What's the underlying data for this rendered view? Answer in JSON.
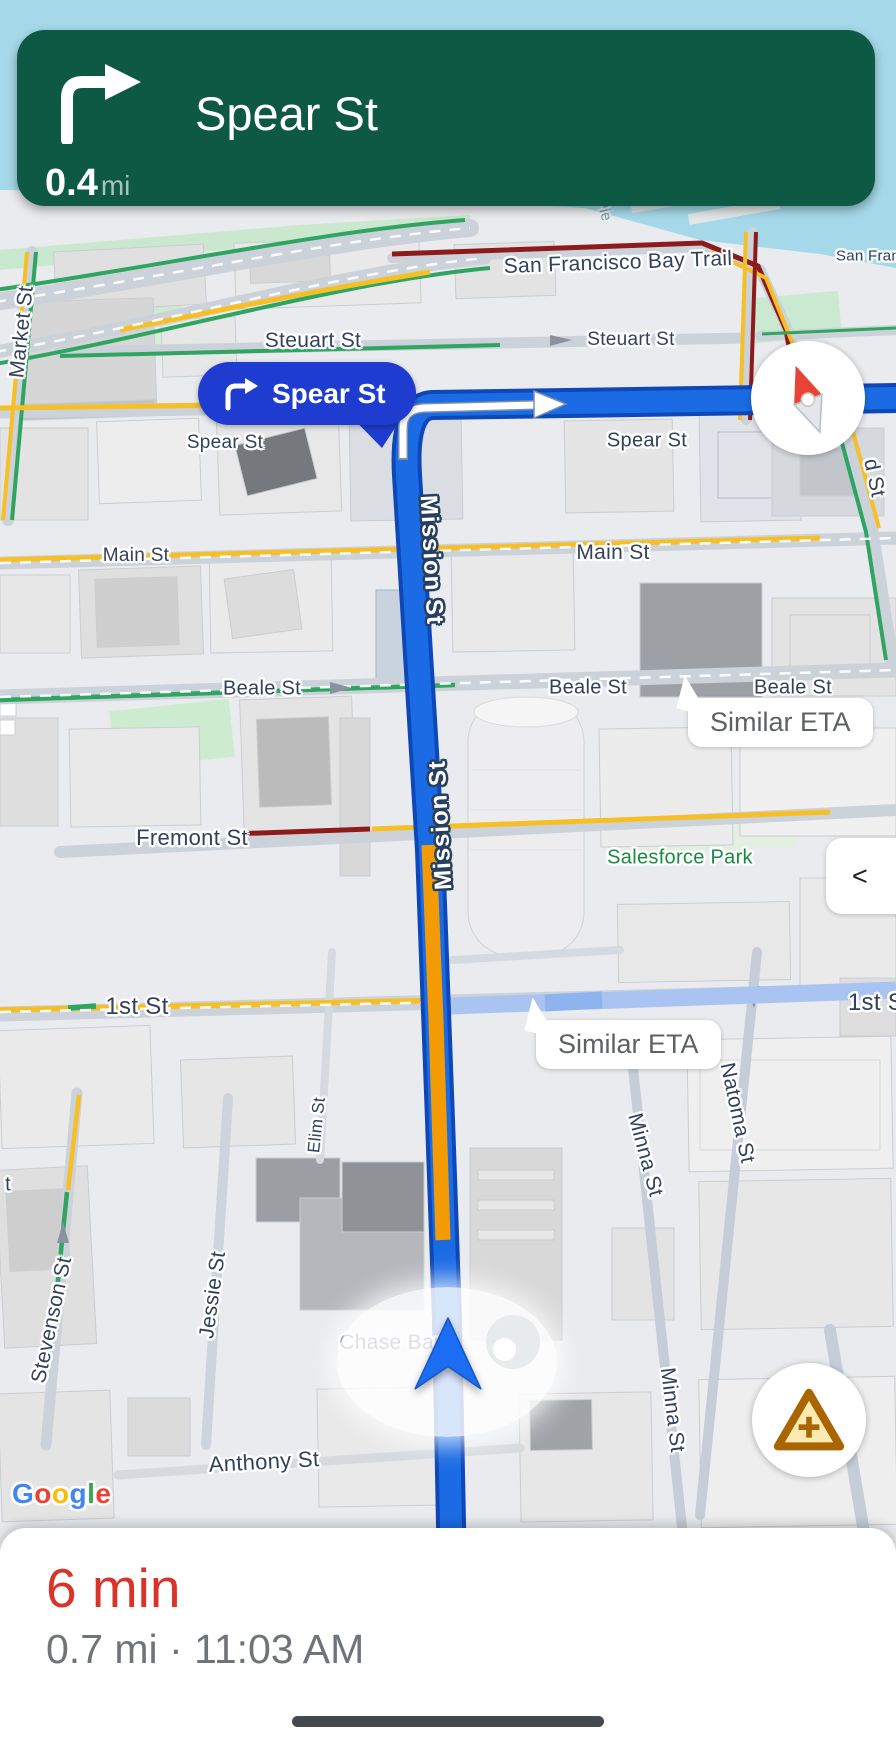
{
  "nav_banner": {
    "street": "Spear St",
    "distance": "0.4",
    "distance_unit": "mi",
    "maneuver_icon": "turn-right-icon",
    "bg_color": "#0d5943"
  },
  "turn_callout": {
    "street": "Spear St",
    "maneuver_icon": "turn-right-icon",
    "bg_color": "#1f3cd1"
  },
  "controls": {
    "compass_icon": "compass-needle-icon",
    "report_icon": "report-incident-warning-icon",
    "collapse_label": "<"
  },
  "bottom_sheet": {
    "eta": "6 min",
    "eta_color": "#da342a",
    "details": "0.7 mi · 11:03 AM"
  },
  "watermark": {
    "text": "Google",
    "letters": [
      {
        "ch": "G",
        "color": "#4285F4"
      },
      {
        "ch": "o",
        "color": "#EA4335"
      },
      {
        "ch": "o",
        "color": "#FBBC05"
      },
      {
        "ch": "g",
        "color": "#4285F4"
      },
      {
        "ch": "l",
        "color": "#34A853"
      },
      {
        "ch": "e",
        "color": "#EA4335"
      }
    ]
  },
  "map": {
    "colors": {
      "water": "#a5d9e9",
      "route": "#1b6ce4",
      "route_border": "#0d47b8",
      "traffic_moderate": "#f29b05",
      "traffic_heavy": "#8e1b1b",
      "traffic_free": "#2fa561",
      "alt_route": "#aac4f1"
    },
    "bubbles": [
      {
        "text": "Similar ETA",
        "x": 688,
        "y": 698
      },
      {
        "text": "Similar ETA",
        "x": 536,
        "y": 1020
      }
    ],
    "labels": [
      {
        "text": "Pie",
        "x": 604,
        "y": 210,
        "rot": 75,
        "kind": "pier",
        "size": 15
      },
      {
        "text": "San Francisco Bay Trail",
        "x": 618,
        "y": 263,
        "rot": -2,
        "kind": "dark",
        "size": 21
      },
      {
        "text": "San Fran",
        "x": 868,
        "y": 256,
        "rot": 0,
        "kind": "dark",
        "size": 15
      },
      {
        "text": "Steuart St",
        "x": 313,
        "y": 341,
        "rot": 0,
        "kind": "dark",
        "size": 21
      },
      {
        "text": "Steuart St",
        "x": 631,
        "y": 340,
        "rot": 0,
        "kind": "dark",
        "size": 19
      },
      {
        "text": "Market St",
        "x": 22,
        "y": 332,
        "rot": -84,
        "kind": "dark",
        "size": 21
      },
      {
        "text": "Spear St",
        "x": 225,
        "y": 443,
        "rot": 0,
        "kind": "dark",
        "size": 19
      },
      {
        "text": "Spear St",
        "x": 647,
        "y": 441,
        "rot": 0,
        "kind": "dark",
        "size": 20
      },
      {
        "text": "d St",
        "x": 874,
        "y": 478,
        "rot": 78,
        "kind": "dark",
        "size": 21
      },
      {
        "text": "Main St",
        "x": 136,
        "y": 556,
        "rot": 0,
        "kind": "dark",
        "size": 19
      },
      {
        "text": "Main St",
        "x": 613,
        "y": 553,
        "rot": 0,
        "kind": "dark",
        "size": 21
      },
      {
        "text": "Mission St",
        "x": 431,
        "y": 560,
        "rot": 87,
        "kind": "route",
        "size": 24
      },
      {
        "text": "Mission St",
        "x": 441,
        "y": 825,
        "rot": -93,
        "kind": "route",
        "size": 24
      },
      {
        "text": "Beale St",
        "x": 262,
        "y": 689,
        "rot": 0,
        "kind": "dark",
        "size": 20
      },
      {
        "text": "Beale St",
        "x": 588,
        "y": 688,
        "rot": 0,
        "kind": "dark",
        "size": 20
      },
      {
        "text": "Beale St",
        "x": 793,
        "y": 688,
        "rot": 0,
        "kind": "dark",
        "size": 20
      },
      {
        "text": "Fremont St",
        "x": 192,
        "y": 838,
        "rot": 0,
        "kind": "dark",
        "size": 22
      },
      {
        "text": "Salesforce Park",
        "x": 680,
        "y": 858,
        "rot": 0,
        "kind": "park",
        "size": 20
      },
      {
        "text": "1st St",
        "x": 137,
        "y": 1007,
        "rot": 0,
        "kind": "dark",
        "size": 24
      },
      {
        "text": "1st S",
        "x": 876,
        "y": 1003,
        "rot": 0,
        "kind": "dark",
        "size": 24
      },
      {
        "text": "Natoma St",
        "x": 737,
        "y": 1113,
        "rot": 78,
        "kind": "dark",
        "size": 21
      },
      {
        "text": "Minna St",
        "x": 645,
        "y": 1155,
        "rot": 75,
        "kind": "dark",
        "size": 21
      },
      {
        "text": "Minna St",
        "x": 672,
        "y": 1410,
        "rot": 83,
        "kind": "dark",
        "size": 21
      },
      {
        "text": "Elim St",
        "x": 317,
        "y": 1125,
        "rot": -84,
        "kind": "dark",
        "size": 17
      },
      {
        "text": "Jessie St",
        "x": 213,
        "y": 1295,
        "rot": -82,
        "kind": "dark",
        "size": 21
      },
      {
        "text": "Stevenson St",
        "x": 52,
        "y": 1320,
        "rot": -78,
        "kind": "dark",
        "size": 21
      },
      {
        "text": "t",
        "x": 8,
        "y": 1185,
        "rot": 0,
        "kind": "dark",
        "size": 20
      },
      {
        "text": "Chase Bank",
        "x": 398,
        "y": 1343,
        "rot": 0,
        "kind": "dark",
        "size": 21
      },
      {
        "text": "Anthony St",
        "x": 264,
        "y": 1462,
        "rot": -3,
        "kind": "dark",
        "size": 22
      }
    ]
  }
}
